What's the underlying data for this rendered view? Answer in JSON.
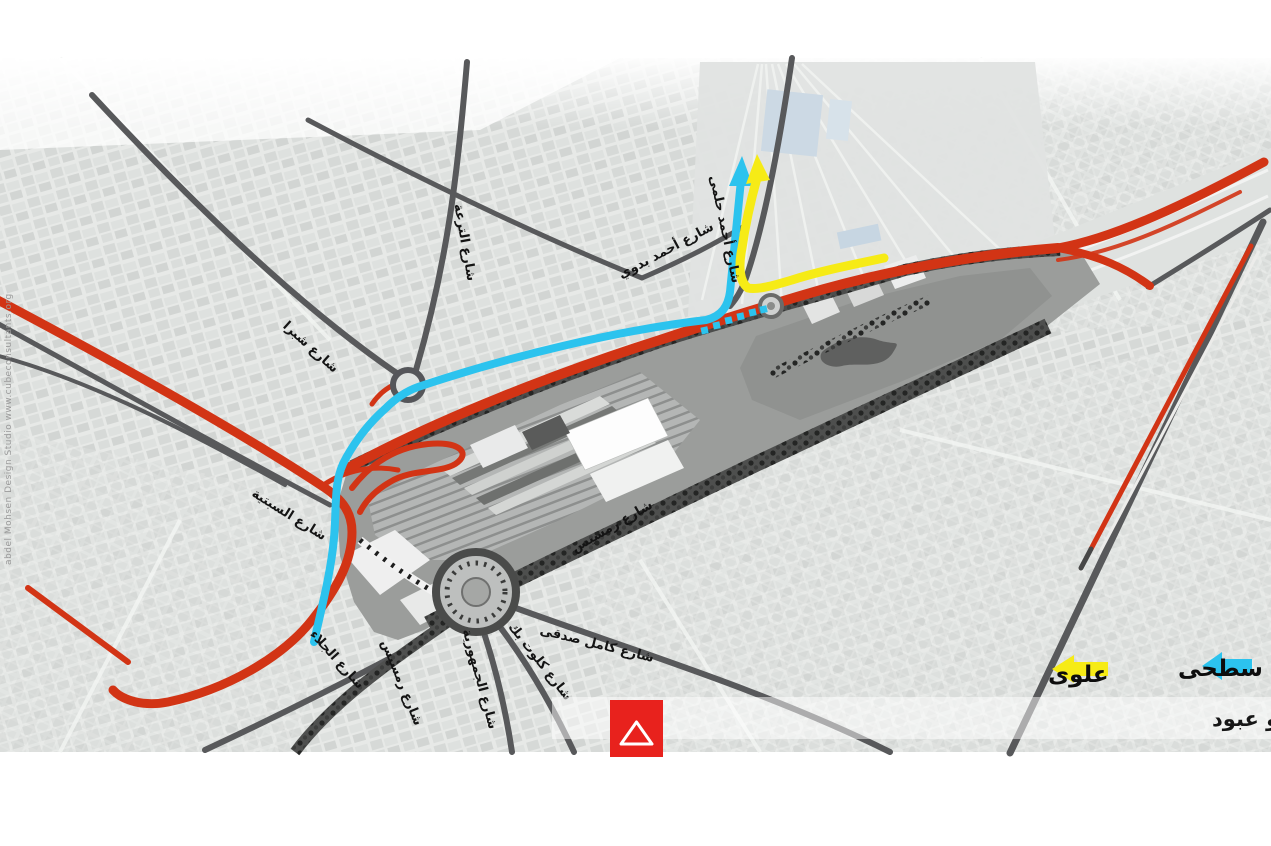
{
  "legend": {
    "surface_label": "سطحى",
    "elevated_label": "علوى",
    "surface_color": "#2cc3ee",
    "elevated_color": "#f6eb16"
  },
  "caption": "حركة السيارات القادمة من غمرة و ميدان رمسيس الي  احمد حلمى و عبود",
  "watermark": "abdel Mohsen Design Studio   www.cubeconsultants.org",
  "streets": {
    "shubra": "شارع شبرا",
    "teraa": "شارع الترعة",
    "badawi": "شارع أحمد بدوي",
    "helmy": "شارع أحمد حلمى",
    "sabtia": "شارع السبتية",
    "galaa": "شارع الجلاء",
    "ramses_mid": "شارع رمسيس",
    "ramses_south": "شارع رمسيس",
    "gomhoria": "شارع الجمهورية",
    "clot_bey": "شارع كلوت بك",
    "kamel_sedky": "شارع كامل صدقى"
  },
  "colors": {
    "highlight_red": "#d23415",
    "route_surface_cyan": "#2cc3ee",
    "route_elevated_yellow": "#f6eb16",
    "road_gray": "#58595b",
    "logo_red": "#e8221d"
  }
}
